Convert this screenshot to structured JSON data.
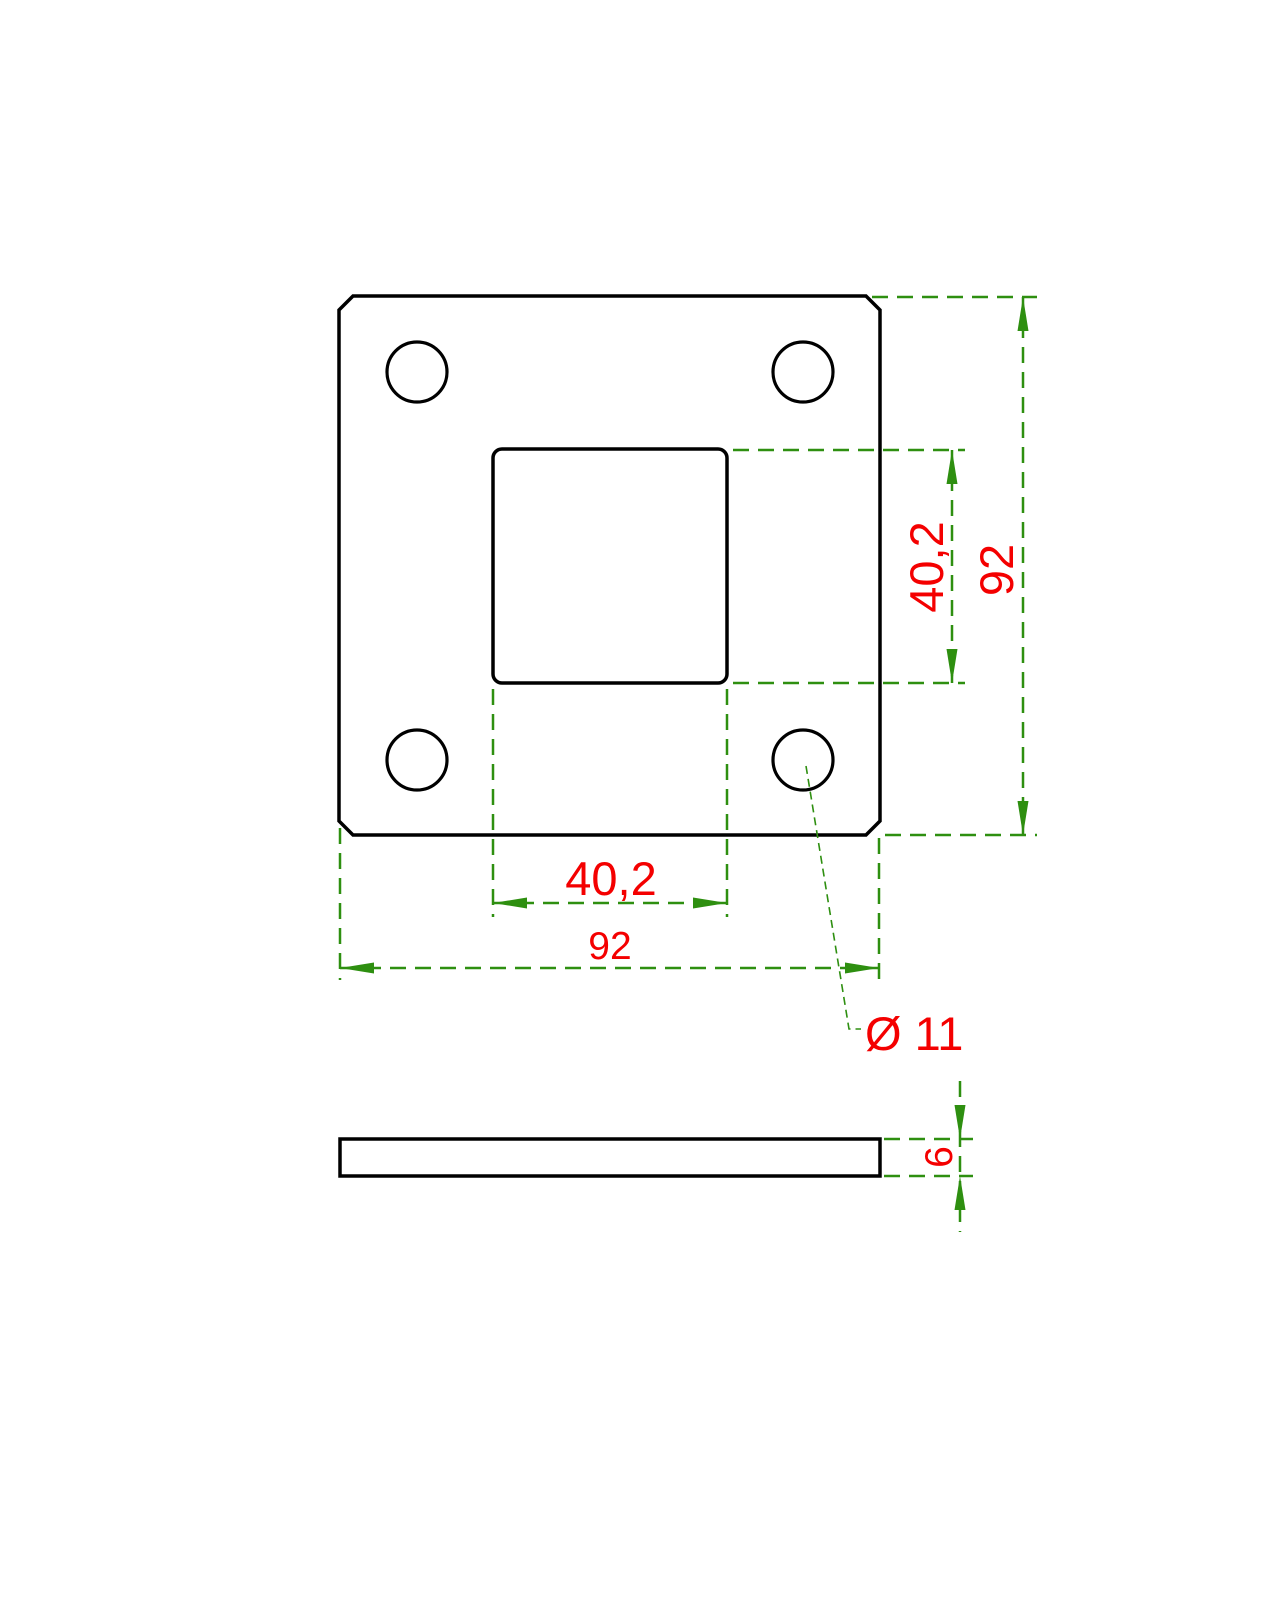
{
  "drawing": {
    "type": "technical-drawing",
    "description": "Square base plate with square center hole and four bolt holes, front view and side (thickness) view",
    "colors": {
      "background": "#ffffff",
      "outline": "#000000",
      "dimension_lines": "#2e8f10",
      "dimension_text": "#f40000"
    },
    "top_view": {
      "dims": {
        "inner_width": "40,2",
        "inner_height": "40,2",
        "outer_width": "92",
        "outer_height": "92",
        "hole_diameter": "Ø 11"
      }
    },
    "side_view": {
      "dims": {
        "thickness": "6"
      }
    }
  }
}
